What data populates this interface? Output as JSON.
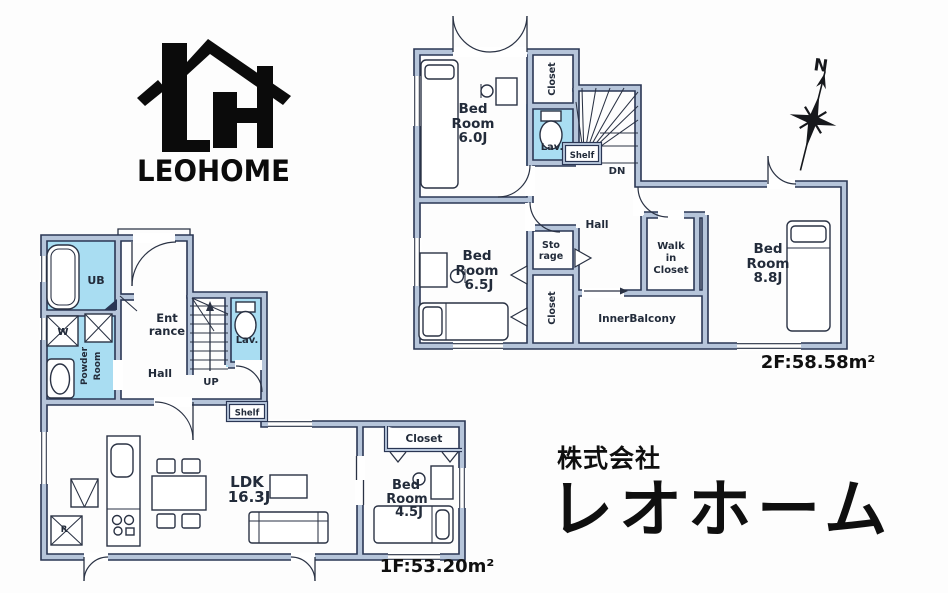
{
  "logo": {
    "wordmark": "LEOHOME"
  },
  "company": {
    "prefix": "株式会社",
    "name": "レオホーム"
  },
  "compass": {
    "north": "N"
  },
  "floor2": {
    "area": "2F:58.58m²",
    "rooms": {
      "bedroom_a": {
        "l1": "Bed",
        "l2": "Room",
        "size": "6.0J"
      },
      "bedroom_b": {
        "l1": "Bed",
        "l2": "Room",
        "size": "6.5J"
      },
      "bedroom_c": {
        "l1": "Bed",
        "l2": "Room",
        "size": "8.8J"
      },
      "walk_in_closet": {
        "l1": "Walk",
        "l2": "in",
        "l3": "Closet"
      },
      "inner_balcony": "InnerBalcony",
      "hall": "Hall",
      "closet_top": "Closet",
      "closet_mid": "Closet",
      "storage": {
        "l1": "Sto",
        "l2": "rage"
      },
      "lavatory": "Lav.",
      "shelf": "Shelf",
      "stairs_down": "DN"
    }
  },
  "floor1": {
    "area": "1F:53.20m²",
    "rooms": {
      "unit_bath": "UB",
      "washer": "W",
      "powder": {
        "l1": "Powder",
        "l2": "Room"
      },
      "entrance": {
        "l1": "Ent",
        "l2": "rance"
      },
      "hall": "Hall",
      "stairs_up": "UP",
      "lavatory": "Lav.",
      "shelf": "Shelf",
      "ldk": {
        "l1": "LDK",
        "size": "16.3J"
      },
      "refrigerator": "R",
      "closet": "Closet",
      "bedroom": {
        "l1": "Bed",
        "l2": "Room",
        "size": "4.5J"
      }
    }
  },
  "colors": {
    "wall_line": "#2a3654",
    "wall_fill": "#b6c5da",
    "wet_area": "#a9ddf2",
    "ink": "#0b0b0b"
  }
}
